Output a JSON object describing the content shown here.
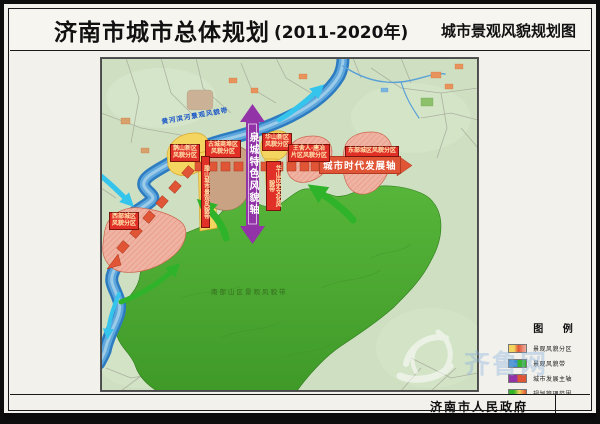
{
  "header": {
    "title": "济南市城市总体规划",
    "title_suffix": "(2011-2020年)",
    "subtitle": "城市景观风貌规划图"
  },
  "map": {
    "axes": {
      "spring_axis": "泉城特色风貌轴",
      "development_axis": "城市时代发展轴"
    },
    "belts": {
      "yellow_river": "黄河滨河景观风貌带",
      "south_mountain": "南部山区景观风貌带",
      "lashan_band": "腊山城市景观风貌带",
      "huashan_band": "华山历史文化风貌带"
    },
    "zones": {
      "queshan": {
        "line1": "鹊山新区",
        "line2": "风貌分区"
      },
      "gucheng": {
        "line1": "古城商埠区",
        "line2": "风貌分区"
      },
      "huashan": {
        "line1": "华山新区",
        "line2": "风貌分区"
      },
      "wangsheren": {
        "line1": "王舍人·唐冶",
        "line2": "片区风貌分区"
      },
      "dongbu": {
        "line1": "东部城区风貌分区"
      },
      "xibu": {
        "line1": "西部城区",
        "line2": "风貌分区"
      }
    },
    "colors": {
      "river": "#2d7bc0",
      "mountain_green": "#4aa62e",
      "axis_purple": "#9333a8",
      "axis_red": "#e05535",
      "zone_yellow": "#f3d45e",
      "zone_pink": "#eeb0a2",
      "zone_tan": "#c9a183"
    }
  },
  "legend": {
    "title": "图 例",
    "items": [
      {
        "label": "景观风貌分区"
      },
      {
        "label": "景观风貌带"
      },
      {
        "label": "城市发展主轴"
      },
      {
        "label": "规划管理范围"
      }
    ]
  },
  "footer": {
    "publisher": "济南市人民政府"
  },
  "watermark": {
    "text": "齐鲁网"
  }
}
